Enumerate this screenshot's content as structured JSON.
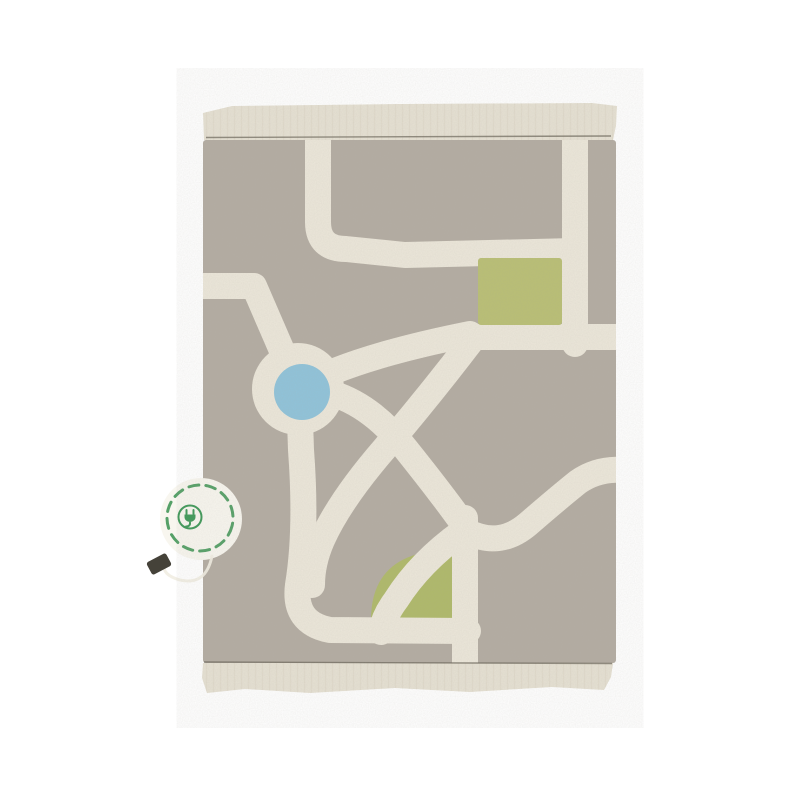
{
  "scene": {
    "type": "product-photo",
    "description": "Top view of a beige washable children's play rug with a tufted city road-map pattern: cream roads, a roundabout with a blue pond, a green park square, a green lawn quarter-circle, fringed top and bottom edges, a circular embroidered badge with a green plug symbol on the left edge, and a small black hang tag.",
    "background_color": "#ffffff"
  },
  "rug": {
    "base_color": "#b3aca2",
    "road_color": "#ece7da",
    "border_band_color": "#e6e1d3",
    "fringe_line_color": "#d8d2c2",
    "accent_colors": {
      "pond_blue": "#8fc3da",
      "park_green": "#b9bf74",
      "lawn_green": "#afb969",
      "stitch_line": "#6f6a5e"
    },
    "features": [
      "top woven band with fringe",
      "stitched guide line top",
      "road network with roundabout",
      "blue pond circle",
      "green park square",
      "green lawn quarter circle",
      "stitched guide line bottom",
      "bottom woven band with fringe"
    ]
  },
  "badge": {
    "shape": "dashed-circle",
    "background": "#f8f6ef",
    "ring_color": "#55a067",
    "icon": "plug-icon",
    "icon_color": "#3e9858"
  },
  "tag": {
    "color": "#454239"
  }
}
